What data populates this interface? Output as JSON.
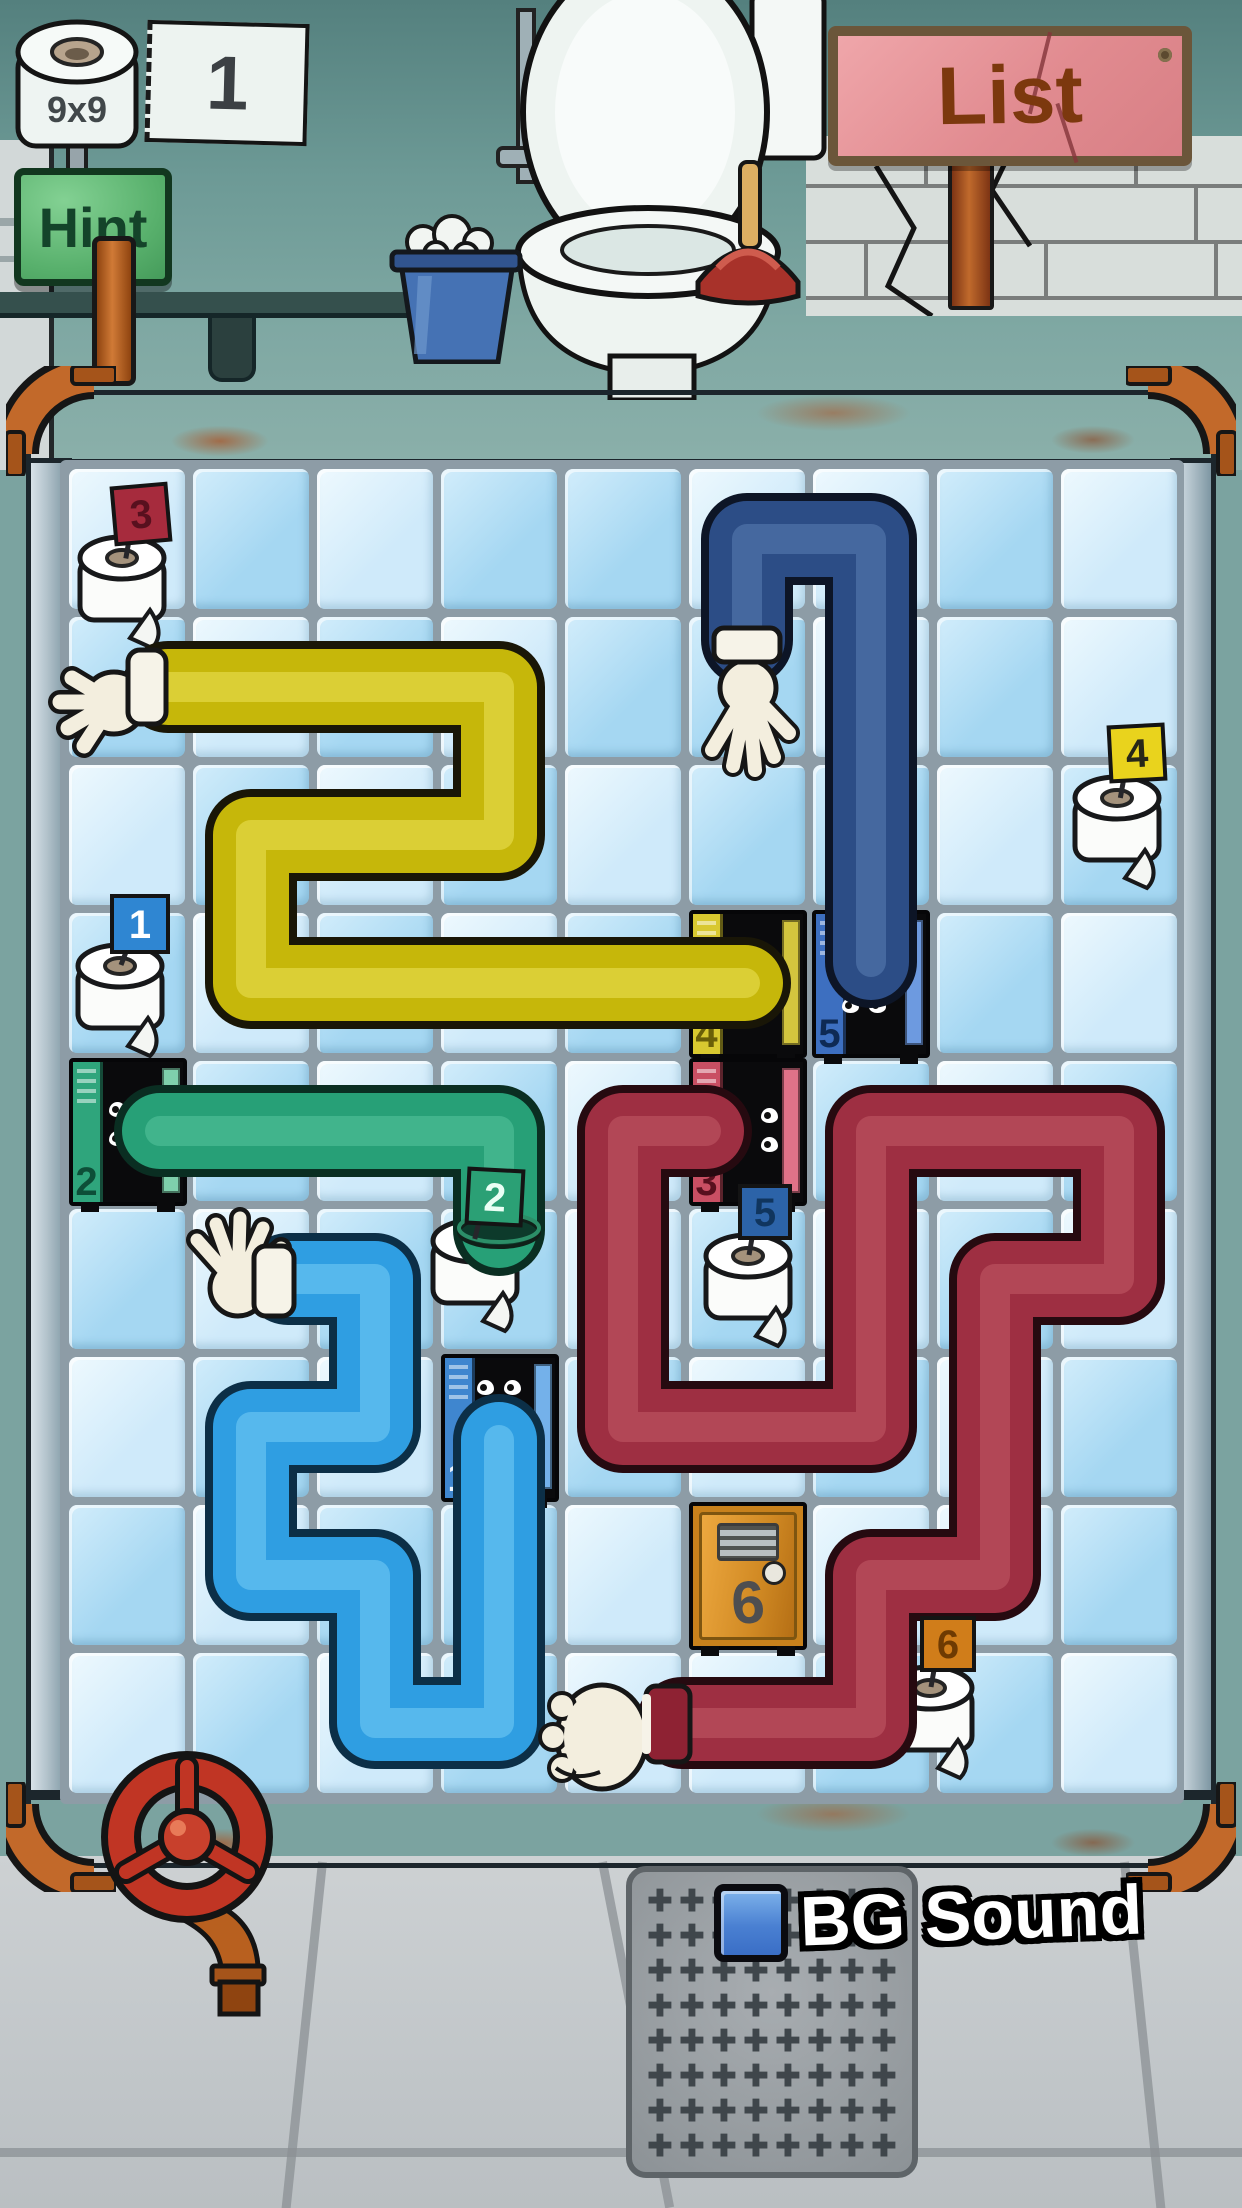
{
  "hud": {
    "size_label": "9x9",
    "level": "1",
    "hint": "Hint",
    "list": "List",
    "bg_sound": "BG Sound"
  },
  "grid": {
    "cols": 9,
    "rows": 9,
    "x": 69,
    "y": 469,
    "cell_w": 116,
    "cell_h": 140,
    "pitch_x": 124,
    "pitch_y": 148,
    "tile_light": "#cfeafa",
    "tile_medium": "#a5d7f2",
    "pattern": [
      "LMLMMLLML",
      "MLMLMMLML",
      "LMLMLMMLM",
      "MLMLMLLML",
      "LMLMLMMLM",
      "MLMMLMLML",
      "LMLLMLMLM",
      "MLMMLMLLM",
      "LMLMLLMML"
    ]
  },
  "lockers": {
    "l1": {
      "number": "1",
      "color": "#3f86cf",
      "state": "open"
    },
    "l2": {
      "number": "2",
      "color": "#2fa57c",
      "state": "open"
    },
    "l3": {
      "number": "3",
      "color": "#c94f63",
      "state": "open"
    },
    "l4": {
      "number": "4",
      "color": "#d8c830",
      "state": "open"
    },
    "l5": {
      "number": "5",
      "color": "#3d6fc0",
      "state": "open"
    },
    "l6": {
      "number": "6",
      "color": "#c8811c",
      "state": "closed"
    }
  },
  "rolls": {
    "r1": {
      "number": "1",
      "flag": "#2f86d2"
    },
    "r2": {
      "number": "2",
      "flag": "#2ba075"
    },
    "r3": {
      "number": "3",
      "flag": "#a62b3d"
    },
    "r4": {
      "number": "4",
      "flag": "#e9d31d"
    },
    "r5": {
      "number": "5",
      "flag": "#2c63a8"
    },
    "r6": {
      "number": "6",
      "flag": "#d07d1a"
    }
  },
  "pipes": [
    {
      "id": "yellow",
      "base": "#c6b70a",
      "light": "#ece35a",
      "outline": "#191607",
      "width": 76,
      "points": [
        [
          168,
          687
        ],
        [
          499,
          687
        ],
        [
          499,
          835
        ],
        [
          251,
          835
        ],
        [
          251,
          983
        ],
        [
          745,
          983
        ]
      ]
    },
    {
      "id": "navy",
      "base": "#2c4d86",
      "light": "#5b7fb5",
      "outline": "#0d1526",
      "width": 76,
      "points": [
        [
          747,
          640
        ],
        [
          747,
          539
        ],
        [
          871,
          539
        ],
        [
          871,
          962
        ]
      ]
    },
    {
      "id": "green",
      "base": "#27a077",
      "light": "#58c49e",
      "outline": "#0a2e22",
      "width": 76,
      "points": [
        [
          160,
          1131
        ],
        [
          499,
          1131
        ],
        [
          499,
          1230
        ]
      ]
    },
    {
      "id": "azure",
      "base": "#2f9ee2",
      "light": "#76cdf5",
      "outline": "#0c2f47",
      "width": 76,
      "points": [
        [
          288,
          1279
        ],
        [
          375,
          1279
        ],
        [
          375,
          1427
        ],
        [
          251,
          1427
        ],
        [
          251,
          1575
        ],
        [
          375,
          1575
        ],
        [
          375,
          1723
        ],
        [
          499,
          1723
        ],
        [
          499,
          1440
        ]
      ]
    },
    {
      "id": "red",
      "base": "#9e2f42",
      "light": "#c25b68",
      "outline": "#260a10",
      "width": 76,
      "points": [
        [
          706,
          1131
        ],
        [
          623,
          1131
        ],
        [
          623,
          1427
        ],
        [
          871,
          1427
        ],
        [
          871,
          1131
        ],
        [
          1119,
          1131
        ],
        [
          1119,
          1279
        ],
        [
          995,
          1279
        ],
        [
          995,
          1575
        ],
        [
          871,
          1575
        ],
        [
          871,
          1723
        ],
        [
          682,
          1723
        ]
      ]
    }
  ],
  "drain": {
    "rows": 8,
    "cols": 8,
    "hole_glyph": "✚"
  }
}
